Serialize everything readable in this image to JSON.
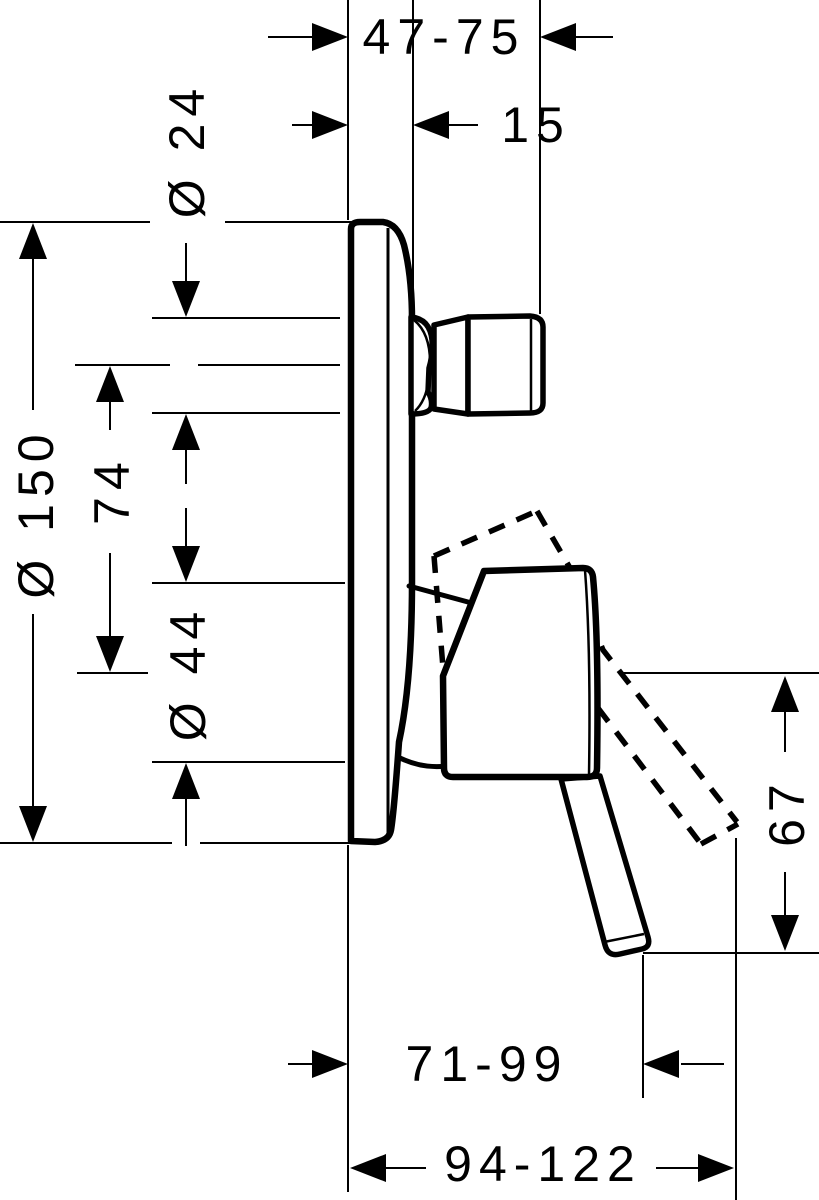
{
  "colors": {
    "ink": "#000000",
    "paper": "#ffffff"
  },
  "dimensions": {
    "wall_depth_range": "47-75",
    "plate_depth": "15",
    "knob_diameter": "Ø 24",
    "plate_diameter": "Ø 150",
    "spout_to_lever_axis": "74",
    "sleeve_diameter": "Ø 44",
    "lever_drop": "67",
    "lever_reach_min": "71-99",
    "lever_reach_max": "94-122"
  }
}
